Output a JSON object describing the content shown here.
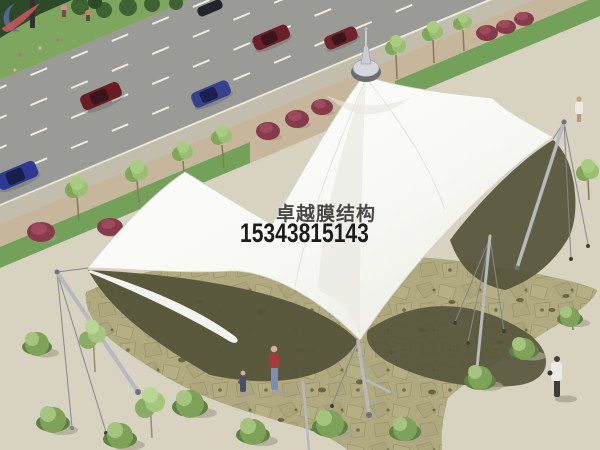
{
  "watermark": {
    "brand": "卓越膜结构",
    "phone": "15343815143",
    "colors": {
      "logo_blue": "#5c6b9c",
      "logo_red": "#d2545e",
      "brand_text": "#4a4845",
      "phone_text": "#1c1c1c"
    }
  },
  "scene": {
    "description": "Aerial architectural rendering: white multi-peak tensile membrane canopy with tilted steel masts and cables over a flagstone plaza, beside a road with cars, sidewalk trees, shrubs and pedestrians",
    "colors": {
      "plaza": "#d8d2c1",
      "road": "#9a9a97",
      "shoulder": "#c3bdad",
      "walk_brown": "#c6b69b",
      "planting_strip": "#74a159",
      "grass": "#7fa65e",
      "hedge": "#2c4a28",
      "flagstone": "#b1aa80",
      "canopy_shadow": "#55543a",
      "membrane_edge": "#d5d5cd",
      "red_bush": "#873a4b",
      "shrub": "#7fa25b",
      "mast": "#b6b9be",
      "cable": "#84878c",
      "lane_line": "#ececdf"
    },
    "cars": [
      {
        "color": "#6b1d26"
      },
      {
        "color": "#6e2028"
      },
      {
        "color": "#71222a"
      },
      {
        "color": "#2c3a95"
      },
      {
        "color": "#35428f"
      },
      {
        "color": "#23252e"
      }
    ]
  }
}
